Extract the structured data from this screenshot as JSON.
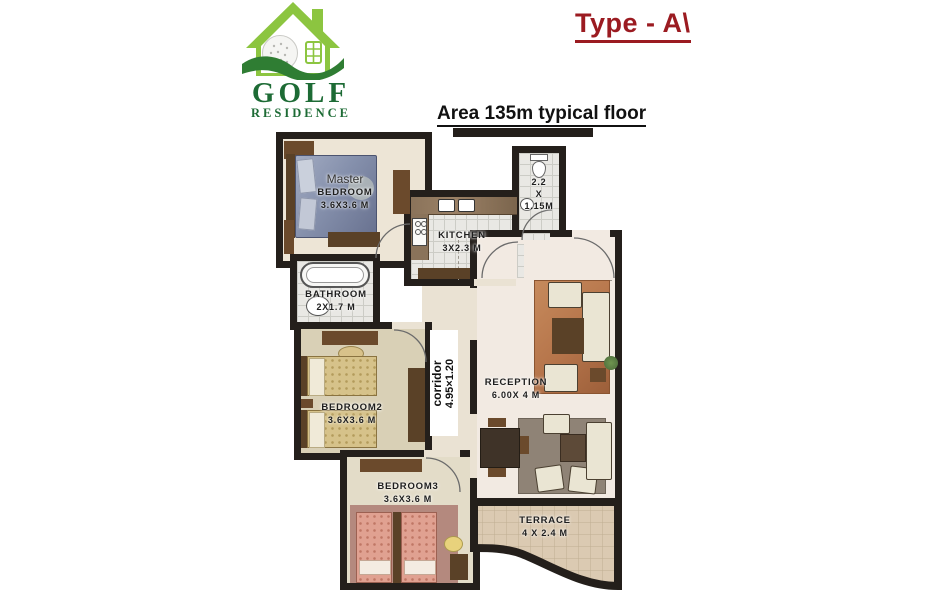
{
  "logo": {
    "line1": "GOLF",
    "line2": "RESIDENCE"
  },
  "header": {
    "type_label": "Type - A\\",
    "area_label": "Area 135m typical floor"
  },
  "colors": {
    "wall": "#241f1b",
    "type_red": "#9b1b21",
    "logo_green": "#8cc540",
    "logo_text_green": "#1d6b35",
    "hill_green": "#2f7d33",
    "terrace_tile": "#dbcab2",
    "master_bed_blue": "#7c87a6",
    "bed_gold": "#d6c28a",
    "bed_pink": "#e0a191",
    "rug_orange": "#b5744a"
  },
  "rooms": {
    "master": {
      "line1": "Master",
      "line2": "BEDROOM",
      "dims": "3.6X3.6 M"
    },
    "kitchen": {
      "name": "KITCHEN",
      "dims": "3X2.3 M"
    },
    "wc": {
      "line1": "2.2",
      "line2": "X",
      "line3": "1.15M"
    },
    "bathroom": {
      "name": "BATHROOM",
      "dims": "2X1.7 M"
    },
    "bedroom2": {
      "name": "BEDROOM2",
      "dims": "3.6X3.6 M"
    },
    "corridor": {
      "name": "corridor",
      "dims": "4.95×1.20"
    },
    "reception": {
      "name": "RECEPTION",
      "dims": "6.00X 4 M"
    },
    "bedroom3": {
      "name": "BEDROOM3",
      "dims": "3.6X3.6 M"
    },
    "terrace": {
      "name": "TERRACE",
      "dims": "4 X 2.4 M"
    }
  }
}
